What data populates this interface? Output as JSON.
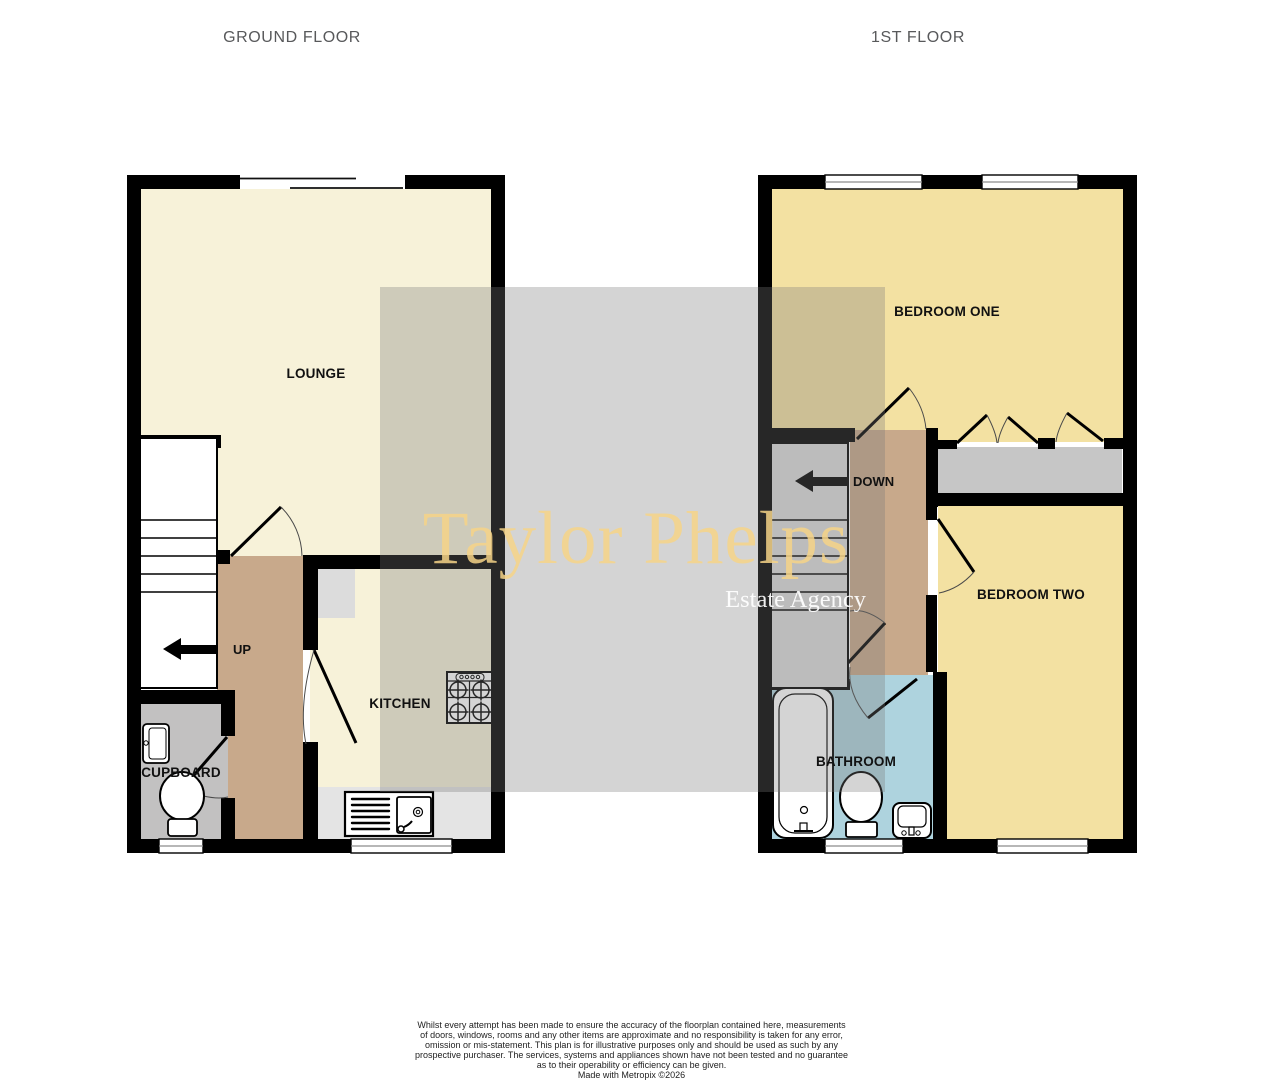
{
  "floor_titles": {
    "ground": "GROUND FLOOR",
    "first": "1ST FLOOR"
  },
  "ground_floor": {
    "lounge_label": "LOUNGE",
    "kitchen_label": "KITCHEN",
    "cupboard_label": "CUPBOARD",
    "stairs_direction_label": "UP"
  },
  "first_floor": {
    "bedroom_one_label": "BEDROOM ONE",
    "bedroom_two_label": "BEDROOM TWO",
    "bathroom_label": "BATHROOM",
    "stairs_direction_label": "DOWN"
  },
  "watermark": {
    "brand": "Taylor Phelps",
    "tagline": "Estate Agency"
  },
  "disclaimer": {
    "lines": [
      "Whilst every attempt has been made to ensure the accuracy of the floorplan contained here, measurements",
      "of doors, windows, rooms and any other items are approximate and no responsibility is taken for any error,",
      "omission or mis-statement. This plan is for illustrative purposes only and should be used as such by any",
      "prospective purchaser. The services, systems and appliances shown have not been tested and no guarantee",
      "as to their operability or efficiency can be given.",
      "Made with Metropix ©2026"
    ]
  },
  "colors": {
    "wall": "#000000",
    "room_cream": "#f7f2d9",
    "room_yellow": "#f3e1a2",
    "hallway_tan": "#c8a98b",
    "cupboard_gray": "#c2c1c1",
    "bathroom_blue": "#aed3de",
    "stairs_ground": "#ffffff",
    "stairs_first": "#dcdcdc",
    "kitchen_counter": "#e4e4e4",
    "kitchen_unit": "#dcdcdc",
    "wardrobe_gray": "#c6c6c6",
    "watermark_overlay": "#7a7a7a",
    "watermark_brand": "#f6d387",
    "watermark_tagline": "#ffffff",
    "floor_title": "#58595b",
    "room_label": "#111111"
  }
}
